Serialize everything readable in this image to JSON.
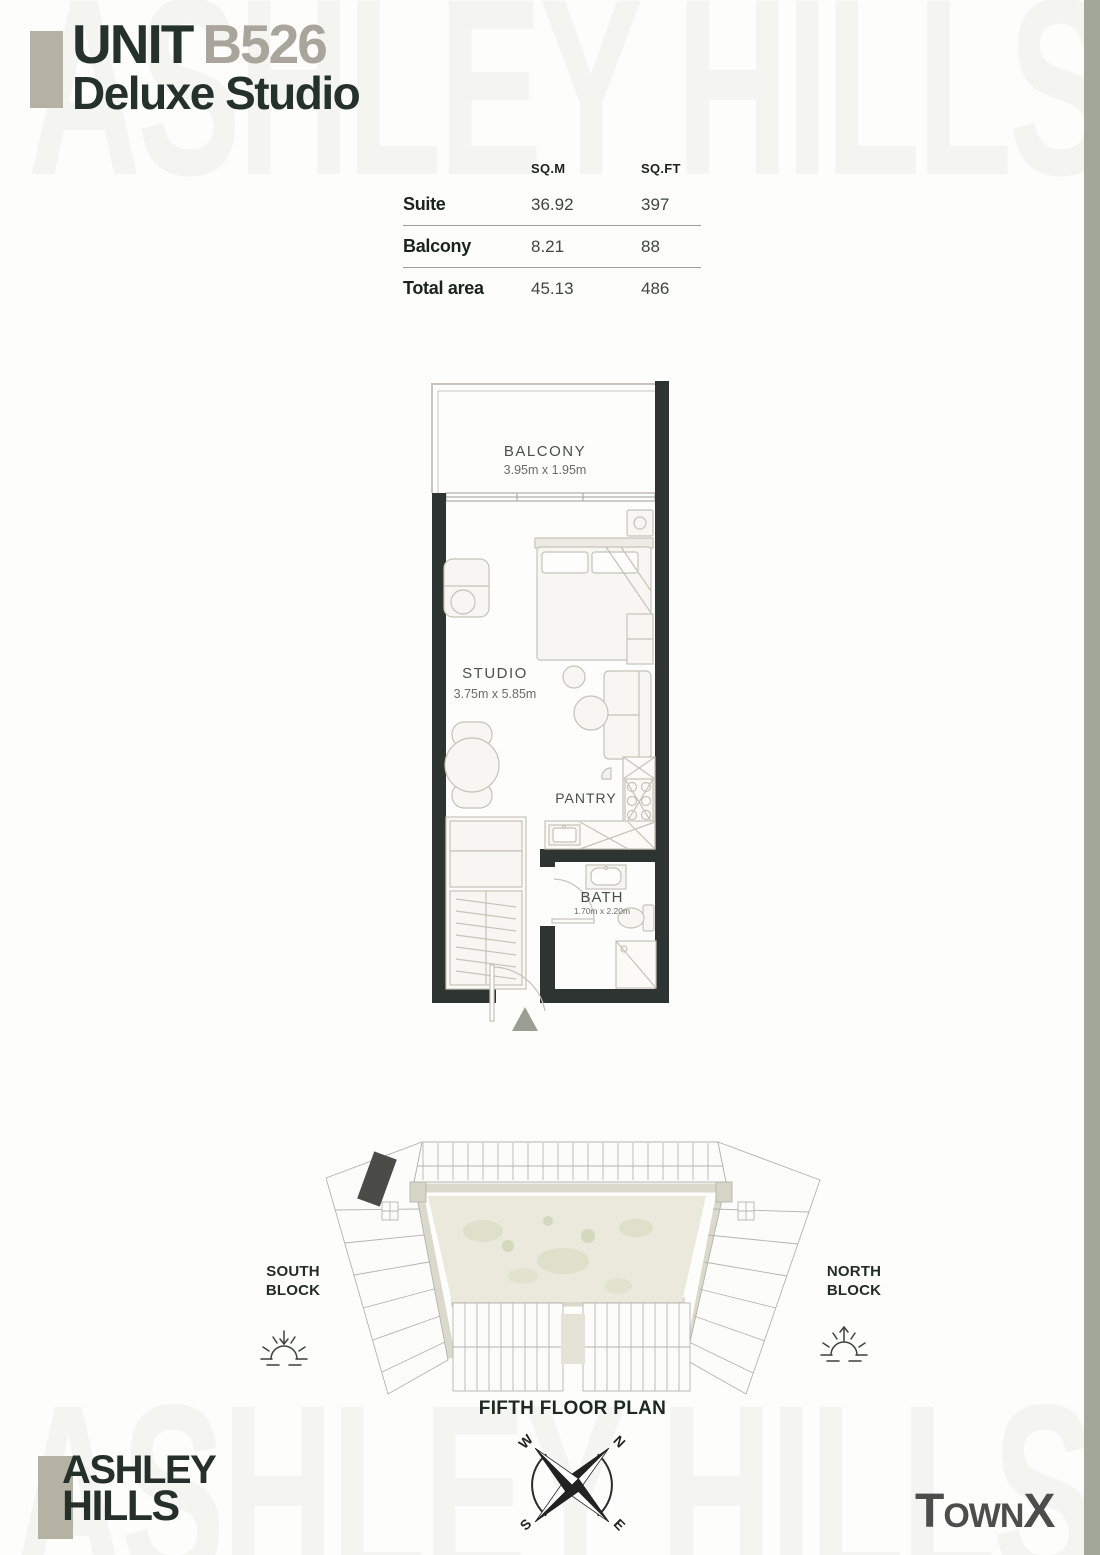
{
  "watermark": {
    "top": "ASHLEY HILLS",
    "bottom": "ASHLEY HILLS"
  },
  "header": {
    "unit_label": "UNIT",
    "unit_number": "B526",
    "unit_type": "Deluxe Studio"
  },
  "area_table": {
    "col_sqm": "SQ.M",
    "col_sqft": "SQ.FT",
    "rows": [
      {
        "label": "Suite",
        "sqm": "36.92",
        "sqft": "397"
      },
      {
        "label": "Balcony",
        "sqm": "8.21",
        "sqft": "88"
      },
      {
        "label": "Total area",
        "sqm": "45.13",
        "sqft": "486"
      }
    ]
  },
  "floor_plan": {
    "balcony": {
      "label": "BALCONY",
      "dim": "3.95m x 1.95m"
    },
    "studio": {
      "label": "STUDIO",
      "dim": "3.75m x 5.85m"
    },
    "pantry": {
      "label": "PANTRY"
    },
    "bath": {
      "label": "BATH",
      "dim": "1.70m x 2.20m"
    }
  },
  "site_plan": {
    "south_block": "SOUTH BLOCK",
    "north_block": "NORTH BLOCK",
    "caption": "FIFTH FLOOR PLAN",
    "compass": {
      "n": "N",
      "e": "E",
      "s": "S",
      "w": "W"
    }
  },
  "branding": {
    "logo_line1": "ASHLEY",
    "logo_line2": "HILLS",
    "developer_prefix": "T",
    "developer_mid": "own",
    "developer_suffix": "X"
  },
  "colors": {
    "ink": "#25322b",
    "accent_taupe": "#b5b2a3",
    "wall": "#2d3431",
    "edge_strip": "#a3a79a",
    "unit_highlight": "#4b4b48",
    "entry_marker": "#99a092"
  }
}
